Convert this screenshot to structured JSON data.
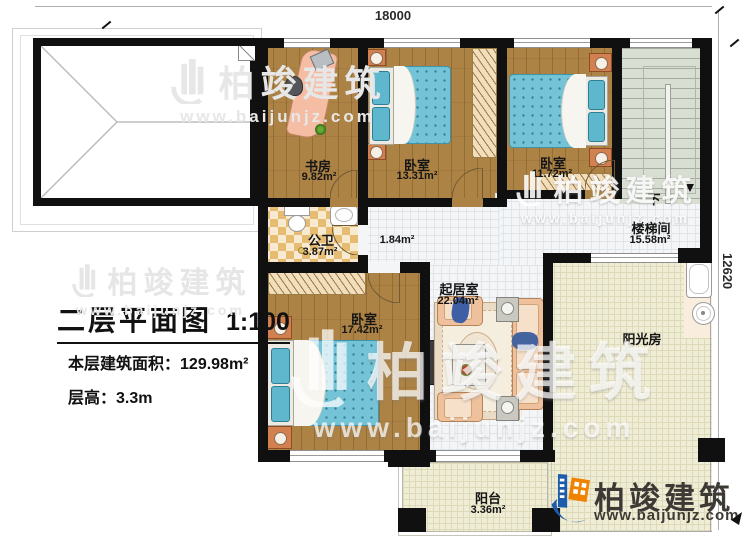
{
  "dimensions": {
    "width_mm": "18000",
    "height_mm": "12620"
  },
  "title_block": {
    "title": "二层平面图",
    "scale": "1:100",
    "area_label": "本层建筑面积：",
    "area_value": "129.98m²",
    "floor_height_label": "层高：",
    "floor_height_value": "3.3m"
  },
  "rooms": [
    {
      "name": "书房",
      "area": "9.82m²"
    },
    {
      "name": "卧室",
      "area": "13.31m²"
    },
    {
      "name": "卧室",
      "area": "11.72m²"
    },
    {
      "name": "楼梯间",
      "area": "15.58m²",
      "down": "下"
    },
    {
      "name": "公卫",
      "area": "3.87m²"
    },
    {
      "area": "1.84m²"
    },
    {
      "name": "卧室",
      "area": "17.42m²"
    },
    {
      "name": "起居室",
      "area": "22.04m²"
    },
    {
      "name": "阳光房"
    },
    {
      "name": "阳台",
      "area": "3.36m²"
    }
  ],
  "branding": {
    "company": "柏竣建筑",
    "website": "www.baijunjz.com"
  },
  "colors": {
    "wall": "#101010",
    "wood_floor": "#ac8245",
    "bed": "#74c3d6",
    "sofa": "#eec19c",
    "tile_floor": "#f3f5f6",
    "cream_floor": "#f0edd6",
    "checker_floor": "#e6bc72",
    "logo_blue": "#1d5bab",
    "logo_orange": "#ef8200"
  }
}
